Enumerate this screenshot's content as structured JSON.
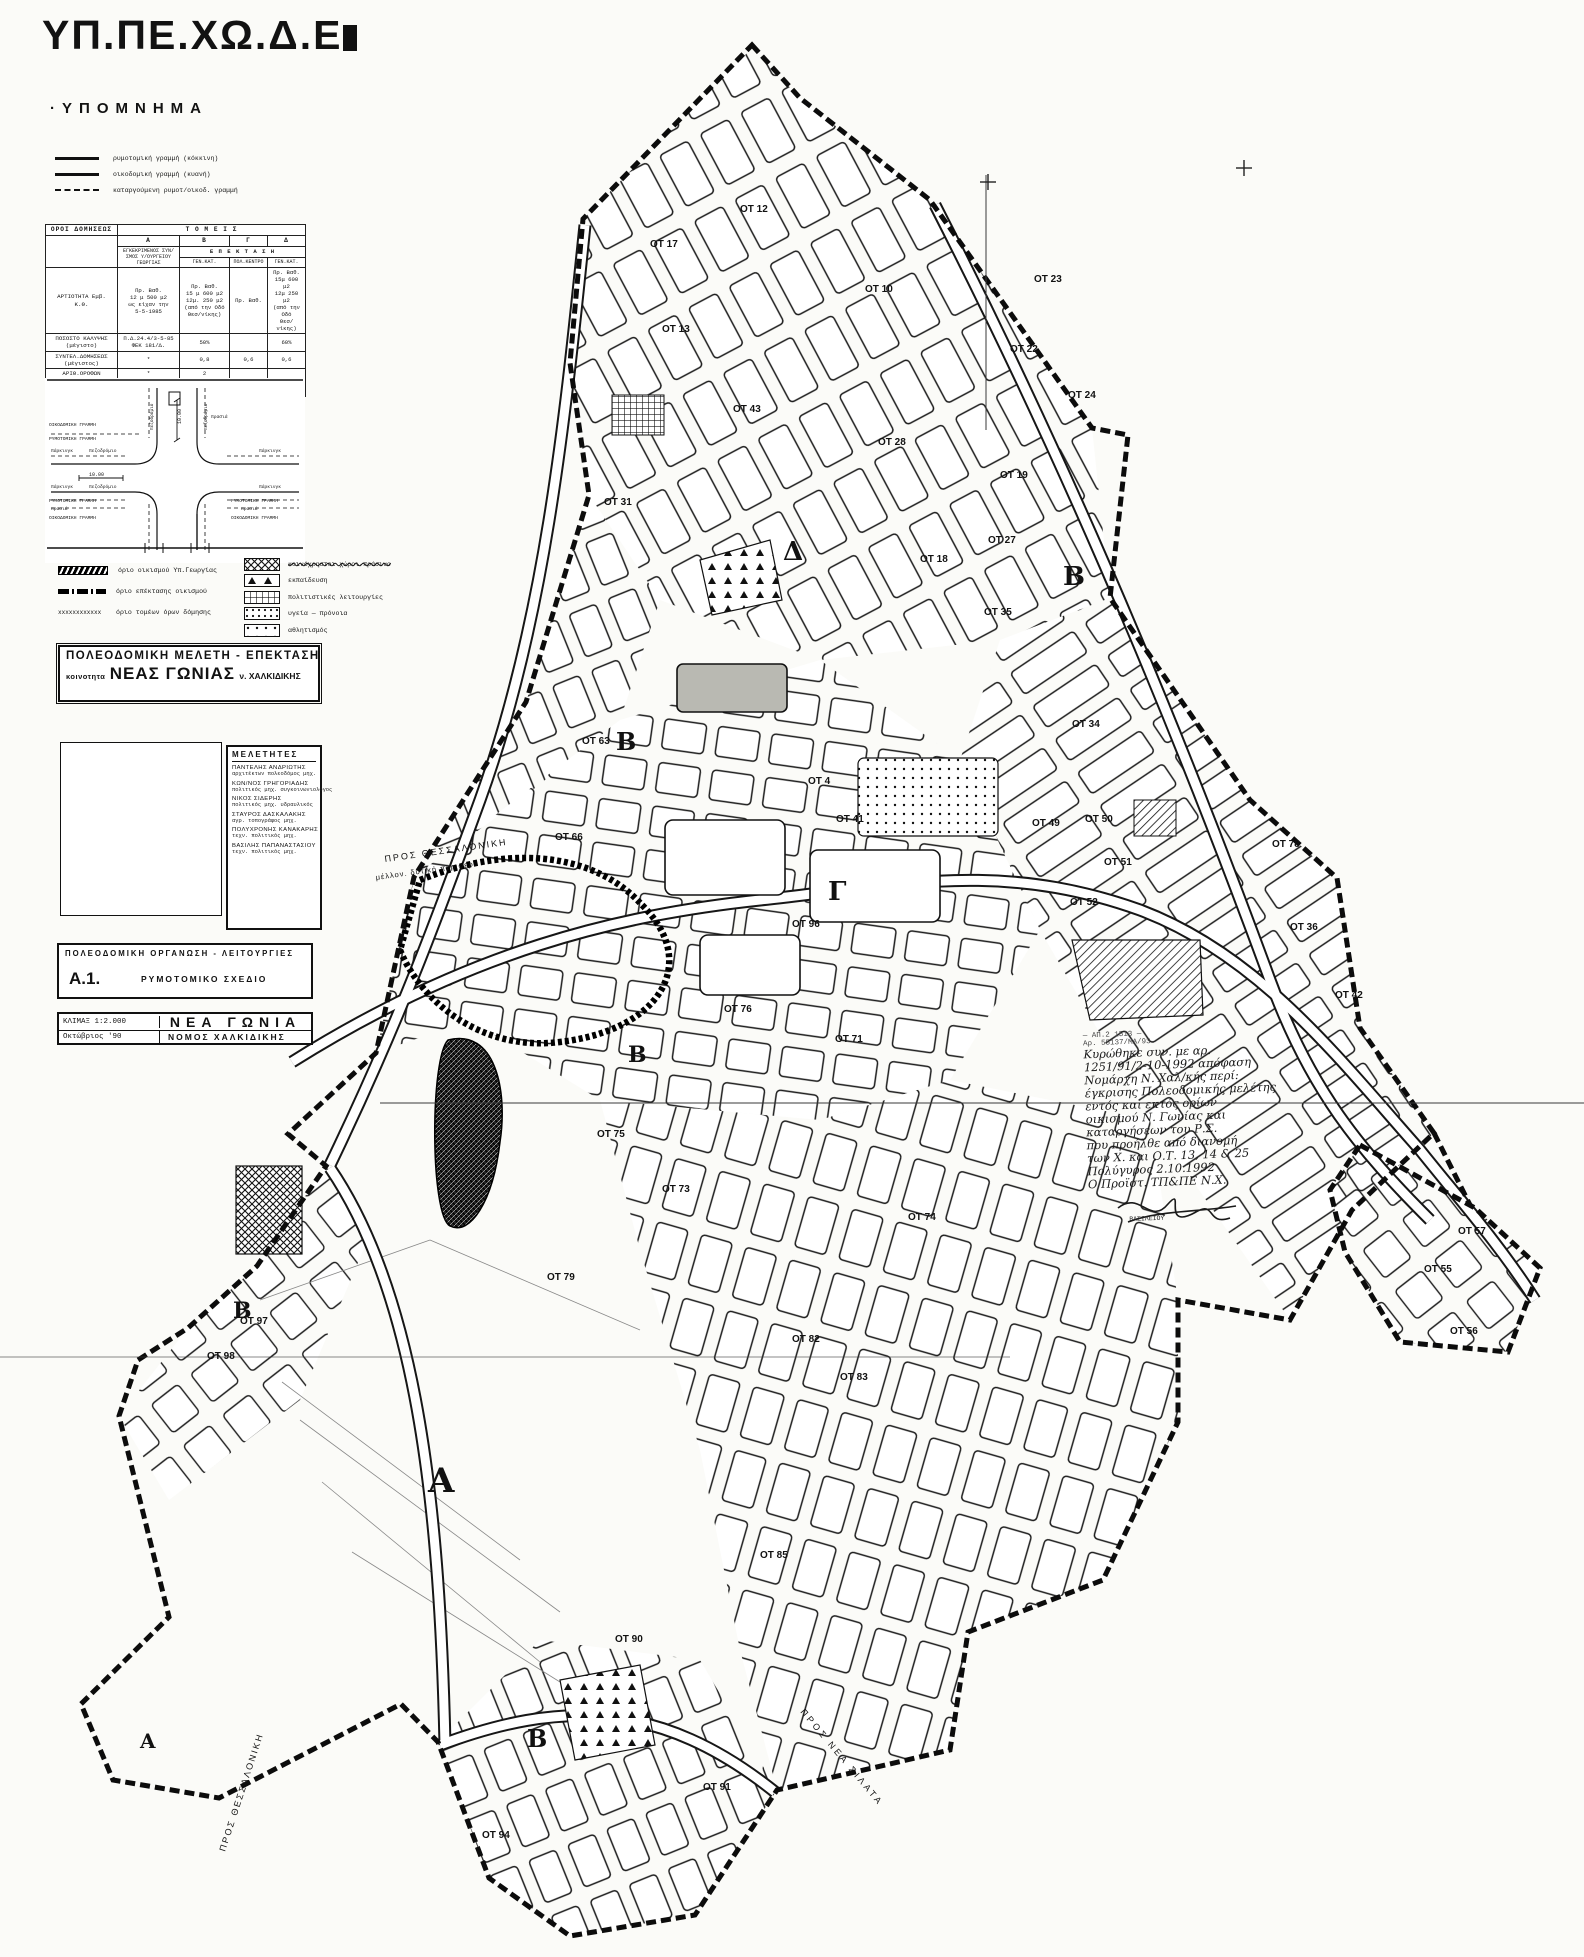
{
  "header": {
    "ministry": "ΥΠ.ΠΕ.ΧΩ.Δ.Ε",
    "legend_title": "·ΥΠΟΜΝΗΜΑ"
  },
  "legend_lines": [
    {
      "style": "solid",
      "label": "ρυμοτομική γραμμή (κόκκινη)"
    },
    {
      "style": "solid",
      "label": "οικοδομική γραμμή (κυανή)"
    },
    {
      "style": "dashed",
      "label": "καταργούμενη ρυμοτ/οικοδ. γραμμή"
    }
  ],
  "terms_table": {
    "corner": "ΟΡΟΙ ΔΟΜΗΣΕΩΣ",
    "sectors_title": "Τ Ο Μ Ε Ι Σ",
    "col_headers": [
      "Α",
      "Β",
      "Γ",
      "Δ"
    ],
    "subheader_a": "ΕΓΚΕΚΡΙΜΕΝΟΣ ΣΥΝ/ΣΜΟΣ Υ/ΟΥΡΓΕΙΟΥ ΓΕΩΡΓΙΑΣ",
    "subheader_ext": "Ε Π Ε Κ Τ Α Σ Η",
    "subheader_cols": [
      "ΓΕΝ.ΚΑΤ.",
      "ΠΟΛ.ΚΕΝΤΡΟ",
      "ΓΕΝ.ΚΑΤ."
    ],
    "rows": [
      {
        "label": "ΑΡΤΙΟΤΗΤΑ  Εμβ.\nΚ.Θ.",
        "a": "Πρ.  Βαθ.\n12 μ 500 μ2\nως είχαν την\n5-5-1985",
        "b": "Πρ.  Βαθ.\n15 μ 600 μ2\n12μ. 250 μ2\n(από την Οδό\nΘεσ/νίκης)",
        "c": "Πρ.  Βαθ.",
        "d": "Πρ.  Βαθ.\n15μ 600 μ2\n12μ 250 μ2\n(από την Οδό\nΘεσ/νίκης)"
      },
      {
        "label": "ΠΟΣΟΣΤΟ ΚΑΛΥΨΗΣ\n(μέγιστο)",
        "a": "Π.Δ.24.4/3-5-85\nΦΕΚ 181/Δ.",
        "b": "50%",
        "c": "",
        "d": "60%"
      },
      {
        "label": "ΣΥΝΤΕΛ.ΔΟΜΗΣΕΩΣ\n(μέγιστος)",
        "a": "*",
        "b": "0,8",
        "c": "0,6",
        "d": "0,6"
      },
      {
        "label": "ΑΡΙΘ.ΟΡΟΦΩΝ",
        "a": "*",
        "b": "2",
        "c": "",
        "d": ""
      },
      {
        "label": "ΥΨΟΣ\n(μέγιστο)",
        "a": "*",
        "b": "7,5μ.",
        "c_struck": "18 μ.",
        "c_hand": "11",
        "d": "8 μ."
      }
    ]
  },
  "diagram": {
    "texts": [
      {
        "t": "ΟΙΚΟΔΟΜΙΚΗ  ΓΡΑΜΜΗ",
        "x": 4,
        "y": 48,
        "s": 4.6
      },
      {
        "t": "ΡΥΜΟΤΟΜΙΚΗ  ΓΡΑΜΜΗ",
        "x": 4,
        "y": 62,
        "s": 4.6
      },
      {
        "t": "πάρκινγκ",
        "x": 6,
        "y": 74,
        "s": 4.6
      },
      {
        "t": "πεζοδρόμιο",
        "x": 44,
        "y": 74,
        "s": 4.6
      },
      {
        "t": "πάρκινγκ",
        "x": 6,
        "y": 110,
        "s": 4.6
      },
      {
        "t": "πεζοδρόμιο",
        "x": 44,
        "y": 110,
        "s": 4.6
      },
      {
        "t": "ΡΥΜΟΤΟΜΙΚΗ  ΓΡΑΜΜΗ",
        "x": 4,
        "y": 124,
        "s": 4.6
      },
      {
        "t": "πρασιά",
        "x": 6,
        "y": 132,
        "s": 4.6
      },
      {
        "t": "ΟΙΚΟΔΟΜΙΚΗ  ΓΡΑΜΜΗ",
        "x": 4,
        "y": 141,
        "s": 4.6
      },
      {
        "t": "πάρκινγκ",
        "x": 214,
        "y": 74,
        "s": 4.6
      },
      {
        "t": "πάρκινγκ",
        "x": 214,
        "y": 110,
        "s": 4.6
      },
      {
        "t": "ΡΥΜΟΤΟΜΙΚΗ ΓΡΑΜΜΗ",
        "x": 186,
        "y": 124,
        "s": 4.6
      },
      {
        "t": "πρασιά",
        "x": 196,
        "y": 132,
        "s": 4.6
      },
      {
        "t": "ΟΙΚΟΔΟΜΙΚΗ ΓΡΑΜΜΗ",
        "x": 186,
        "y": 141,
        "s": 4.6
      },
      {
        "t": "πρασιά",
        "x": 166,
        "y": 40,
        "s": 4.6
      },
      {
        "t": "πεζοδρόμιο",
        "x": 108,
        "y": 52,
        "s": 4.4,
        "r": -90
      },
      {
        "t": "πεζοδρόμιο",
        "x": 162,
        "y": 52,
        "s": 4.4,
        "r": -90
      },
      {
        "t": "10.00",
        "x": 136,
        "y": 46,
        "s": 5,
        "r": -90
      },
      {
        "t": "10.00",
        "x": 44,
        "y": 98,
        "s": 5
      }
    ]
  },
  "boundary_symbols": [
    {
      "type": "hatch",
      "label": "όριο οικισμού Υπ.Γεωργίας"
    },
    {
      "type": "dashdot",
      "label": "όριο επέκτασης οικισμού"
    },
    {
      "type": "xxx",
      "label": "όριο τομέων όρων δόμησης"
    }
  ],
  "landuse_symbols": [
    {
      "type": "xhatch",
      "label": "κοινόχρηστοι χώροι-πράσινο",
      "overwritten": true
    },
    {
      "type": "tris",
      "label": "εκπαίδευση"
    },
    {
      "type": "gridp",
      "label": "πολιτιστικές λειτουργίες"
    },
    {
      "type": "dotsD",
      "label": "υγεία — πρόνοια"
    },
    {
      "type": "dotsS",
      "label": "αθλητισμός"
    }
  ],
  "title_block": {
    "line1": "ΠΟΛΕΟΔΟΜΙΚΗ ΜΕΛΕΤΗ - ΕΠΕΚΤΑΣΗ",
    "prefix": "κοινοτητα",
    "name": "ΝΕΑΣ ΓΩΝΙΑΣ",
    "suffix": "ν. ΧΑΛΚΙΔΙΚΗΣ"
  },
  "consultants": {
    "title": "ΜΕΛΕΤΗΤΕΣ",
    "people": [
      {
        "name": "ΠΑΝΤΕΛΗΣ ΑΝΔΡΙΩΤΗΣ",
        "role": "αρχιτέκτων πολεοδόμος μηχ."
      },
      {
        "name": "ΚΩΝ/ΝΟΣ ΓΡΗΓΟΡΙΑΔΗΣ",
        "role": "πολιτικός μηχ. συγκοινωνιολόγος"
      },
      {
        "name": "ΝΙΚΟΣ ΣΙΔΕΡΗΣ",
        "role": "πολιτικός μηχ. υδραυλικός"
      },
      {
        "name": "ΣΤΑΥΡΟΣ ΔΑΣΚΑΛΑΚΗΣ",
        "role": "αγρ. τοπογράφος μηχ."
      },
      {
        "name": "ΠΟΛΥΧΡΟΝΗΣ ΚΑΝΑΚΑΡΗΣ",
        "role": "τεχν. πολιτικός μηχ."
      },
      {
        "name": "ΒΑΣΙΛΗΣ ΠΑΠΑΝΑΣΤΑΣΙΟΥ",
        "role": "τεχν. πολιτικός μηχ."
      }
    ]
  },
  "sheet_block": {
    "org_line": "ΠΟΛΕΟΔΟΜΙΚΗ  ΟΡΓΑΝΩΣΗ - ΛΕΙΤΟΥΡΓΙΕΣ",
    "code": "Α.1.",
    "sheet_title": "ΡΥΜΟΤΟΜΙΚΟ  ΣΧΕΔΙΟ"
  },
  "scale_block": {
    "scale": "ΚΛΙΜΑΞ 1:2.000",
    "town": "ΝΕΑ  ΓΩΝΙΑ",
    "date": "Οκτώβριος '90",
    "prefecture": "ΝΟΜΟΣ  ΧΑΛΚΙΔΙΚΗΣ"
  },
  "map": {
    "zone_labels": [
      {
        "t": "Δ",
        "x": 783,
        "y": 560,
        "s": 26
      },
      {
        "t": "Β",
        "x": 1063,
        "y": 585,
        "s": 26
      },
      {
        "t": "Β",
        "x": 616,
        "y": 750,
        "s": 24
      },
      {
        "t": "Γ",
        "x": 828,
        "y": 900,
        "s": 26
      },
      {
        "t": "Β",
        "x": 628,
        "y": 1062,
        "s": 22
      },
      {
        "t": "Β",
        "x": 233,
        "y": 1318,
        "s": 22
      },
      {
        "t": "Α",
        "x": 428,
        "y": 1492,
        "s": 34
      },
      {
        "t": "Β",
        "x": 527,
        "y": 1747,
        "s": 24
      },
      {
        "t": "Α",
        "x": 140,
        "y": 1748,
        "s": 20
      }
    ],
    "block_labels": [
      {
        "t": "ΟΤ 12",
        "x": 740,
        "y": 212
      },
      {
        "t": "ΟΤ 17",
        "x": 650,
        "y": 247
      },
      {
        "t": "ΟΤ 10",
        "x": 865,
        "y": 292
      },
      {
        "t": "ΟΤ 13",
        "x": 662,
        "y": 332
      },
      {
        "t": "ΟΤ 23",
        "x": 1034,
        "y": 282
      },
      {
        "t": "ΟΤ 22",
        "x": 1010,
        "y": 352
      },
      {
        "t": "ΟΤ 24",
        "x": 1068,
        "y": 398
      },
      {
        "t": "ΟΤ 43",
        "x": 733,
        "y": 412
      },
      {
        "t": "ΟΤ 28",
        "x": 878,
        "y": 445
      },
      {
        "t": "ΟΤ 19",
        "x": 1000,
        "y": 478
      },
      {
        "t": "ΟΤ 31",
        "x": 604,
        "y": 505
      },
      {
        "t": "ΟΤ 27",
        "x": 988,
        "y": 543
      },
      {
        "t": "ΟΤ 18",
        "x": 920,
        "y": 562
      },
      {
        "t": "ΟΤ 35",
        "x": 984,
        "y": 615
      },
      {
        "t": "ΟΤ 34",
        "x": 1072,
        "y": 727
      },
      {
        "t": "ΟΤ 63",
        "x": 582,
        "y": 744
      },
      {
        "t": "ΟΤ 4",
        "x": 808,
        "y": 784
      },
      {
        "t": "ΟΤ 66",
        "x": 555,
        "y": 840
      },
      {
        "t": "ΟΤ 41",
        "x": 836,
        "y": 822
      },
      {
        "t": "ΟΤ 49",
        "x": 1032,
        "y": 826
      },
      {
        "t": "ΟΤ 50",
        "x": 1085,
        "y": 822
      },
      {
        "t": "ΟΤ 51",
        "x": 1104,
        "y": 865
      },
      {
        "t": "ΟΤ 52",
        "x": 1070,
        "y": 905
      },
      {
        "t": "ΟΤ 78",
        "x": 1272,
        "y": 847
      },
      {
        "t": "ΟΤ 36",
        "x": 1290,
        "y": 930
      },
      {
        "t": "ΟΤ 42",
        "x": 1335,
        "y": 998
      },
      {
        "t": "ΟΤ 96",
        "x": 792,
        "y": 927
      },
      {
        "t": "ΟΤ 76",
        "x": 724,
        "y": 1012
      },
      {
        "t": "ΟΤ 71",
        "x": 835,
        "y": 1042
      },
      {
        "t": "ΟΤ 75",
        "x": 597,
        "y": 1137
      },
      {
        "t": "ΟΤ 73",
        "x": 662,
        "y": 1192
      },
      {
        "t": "ΟΤ 74",
        "x": 908,
        "y": 1220
      },
      {
        "t": "ΟΤ 79",
        "x": 547,
        "y": 1280
      },
      {
        "t": "ΟΤ 97",
        "x": 240,
        "y": 1324
      },
      {
        "t": "ΟΤ 98",
        "x": 207,
        "y": 1359
      },
      {
        "t": "ΟΤ 82",
        "x": 792,
        "y": 1342
      },
      {
        "t": "ΟΤ 83",
        "x": 840,
        "y": 1380
      },
      {
        "t": "ΟΤ 85",
        "x": 760,
        "y": 1558
      },
      {
        "t": "ΟΤ 90",
        "x": 615,
        "y": 1642
      },
      {
        "t": "ΟΤ 91",
        "x": 703,
        "y": 1790
      },
      {
        "t": "ΟΤ 94",
        "x": 482,
        "y": 1838
      },
      {
        "t": "ΟΤ 57",
        "x": 1458,
        "y": 1234
      },
      {
        "t": "ΟΤ 55",
        "x": 1424,
        "y": 1272
      },
      {
        "t": "ΟΤ 56",
        "x": 1450,
        "y": 1334
      }
    ],
    "road_labels": [
      {
        "t": "ΠΡΟΣ  ΘΕΣΣΑΛΟΝΙΚΗ",
        "x": 385,
        "y": 862,
        "s": 9,
        "r": -8,
        "ls": 2
      },
      {
        "t": "μέλλον. δυτική περιφερ.",
        "x": 376,
        "y": 880,
        "s": 7.5,
        "r": -8,
        "ls": 1
      },
      {
        "t": "ΠΡΟΣ  ΘΕΣΣΑΛΟΝΙΚΗ",
        "x": 225,
        "y": 1852,
        "s": 9,
        "r": -72,
        "ls": 2
      },
      {
        "t": "ΠΡΟΣ  ΝΕΑ  ΣΙΛΑΤΑ",
        "x": 800,
        "y": 1712,
        "s": 9,
        "r": 50,
        "ls": 3
      }
    ],
    "annotation": {
      "stamp_lines": [
        "— ΑΠ.2 1513 —",
        "Αρ. 55137/ΜΑ/93"
      ],
      "lines": [
        "Κυρώθηκε συν. με αρ.",
        "1251/91/2-10-1992 απόφαση",
        "Νομάρχη Ν. Χαλ/κής περί:",
        "έγκρισης Πολεοδομικής μελέτης",
        "εντός και εκτός ορίων",
        "οικισμού Ν. Γωνίας και",
        "καταργήσεων του Ρ.Σ.",
        "που προήλθε από διανομή",
        "των Χ. και Ο.Τ. 13, 14 & 25",
        "Πολύγυρος 2.10.1992",
        "Ο Προϊστ. ΤΠ&ΠΕ Ν.Χ."
      ],
      "signature": "ΒΑΣΙΛΕΙΟΥ"
    }
  }
}
